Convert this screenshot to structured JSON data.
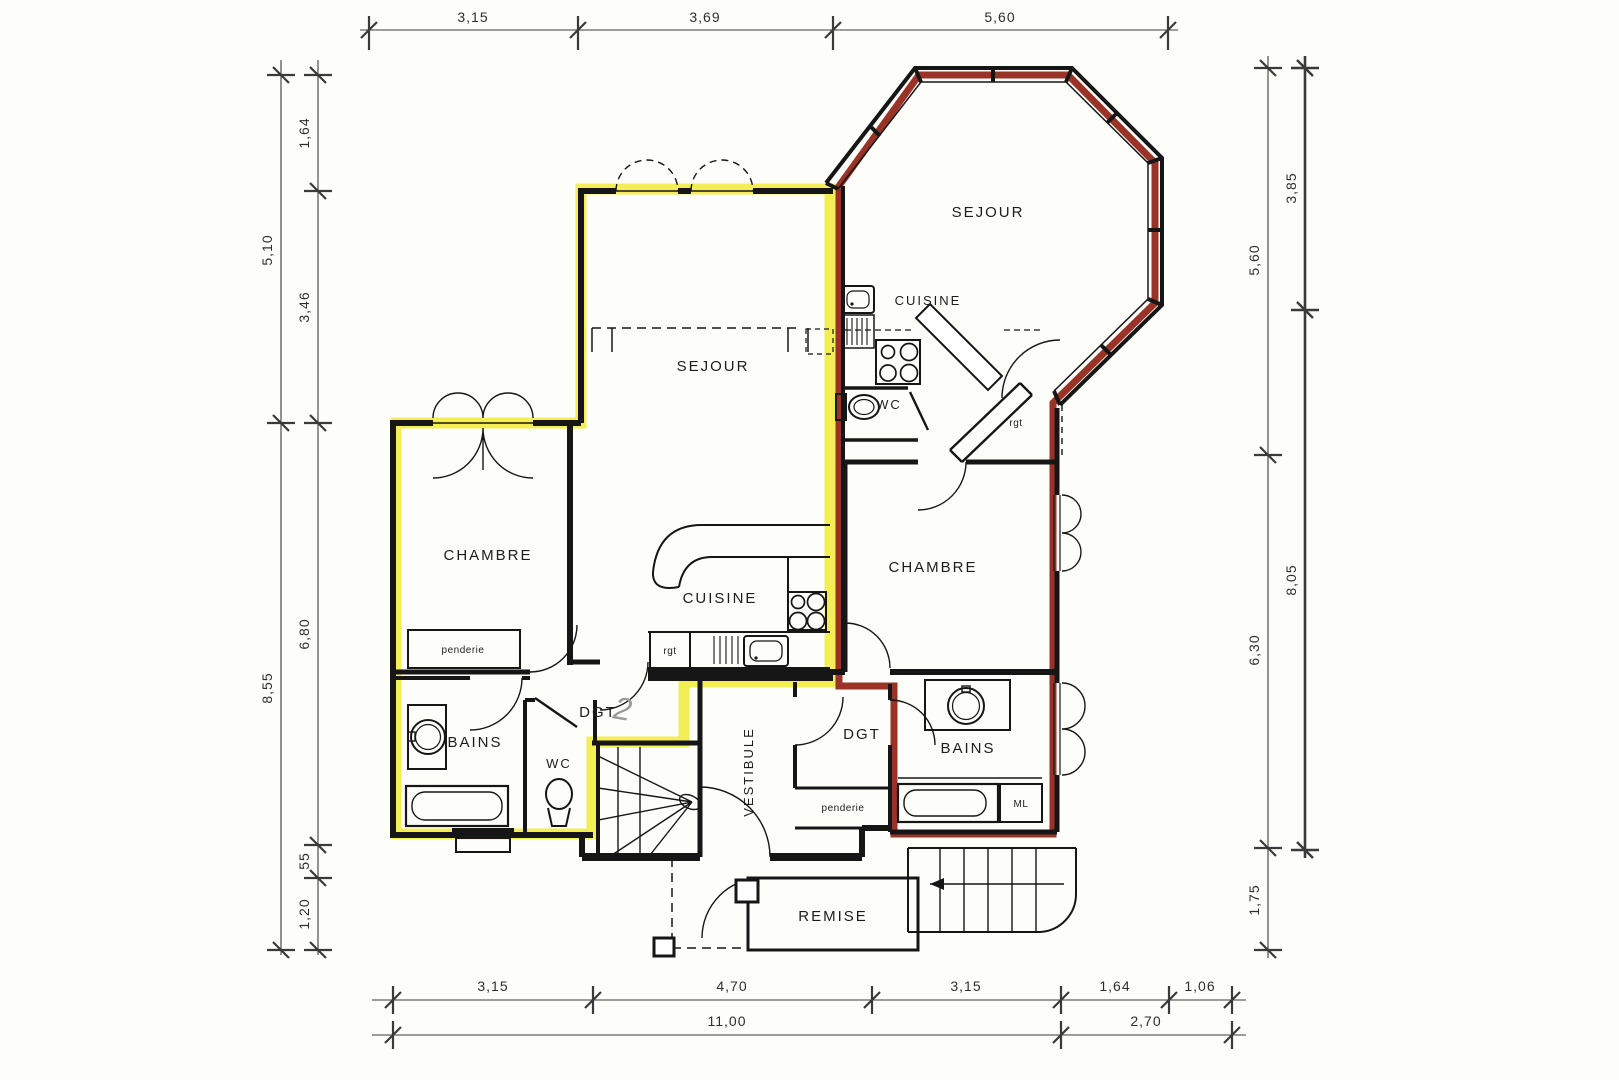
{
  "rooms": {
    "sejour_octagon": "SEJOUR",
    "cuisine_top": "CUISINE",
    "wc_top": "WC",
    "rgt_top": "rgt",
    "sejour_main": "SEJOUR",
    "chambre_left": "CHAMBRE",
    "penderie_left": "penderie",
    "cuisine_main": "CUISINE",
    "rgt_main": "rgt",
    "chambre_right": "CHAMBRE",
    "bains_left": "BAINS",
    "wc_left": "WC",
    "dgt_left": "DGT",
    "dgt_left_note": "2",
    "vestibule": "VESTIBULE",
    "dgt_right": "DGT",
    "penderie_right": "penderie",
    "bains_right": "BAINS",
    "ml": "ML",
    "remise": "REMISE"
  },
  "dimensions": {
    "top": [
      "3,15",
      "3,69",
      "5,60"
    ],
    "left_outer": [
      "5,10",
      "8,55"
    ],
    "left_inner": [
      "1,64",
      "3,46",
      "6,80",
      "55",
      "1,20"
    ],
    "right_inner": [
      "5,60",
      "6,30",
      "1,75"
    ],
    "right_outer": [
      "3,85",
      "8,05"
    ],
    "bottom_upper": [
      "3,15",
      "4,70",
      "3,15",
      "1,64",
      "1,06"
    ],
    "bottom_lower": [
      "11,00",
      "2,70"
    ]
  },
  "colors": {
    "highlight_yellow": "#f1ea38",
    "highlight_red": "#8e1d10",
    "wall": "#161616",
    "pencil": "#9a9a9a"
  }
}
